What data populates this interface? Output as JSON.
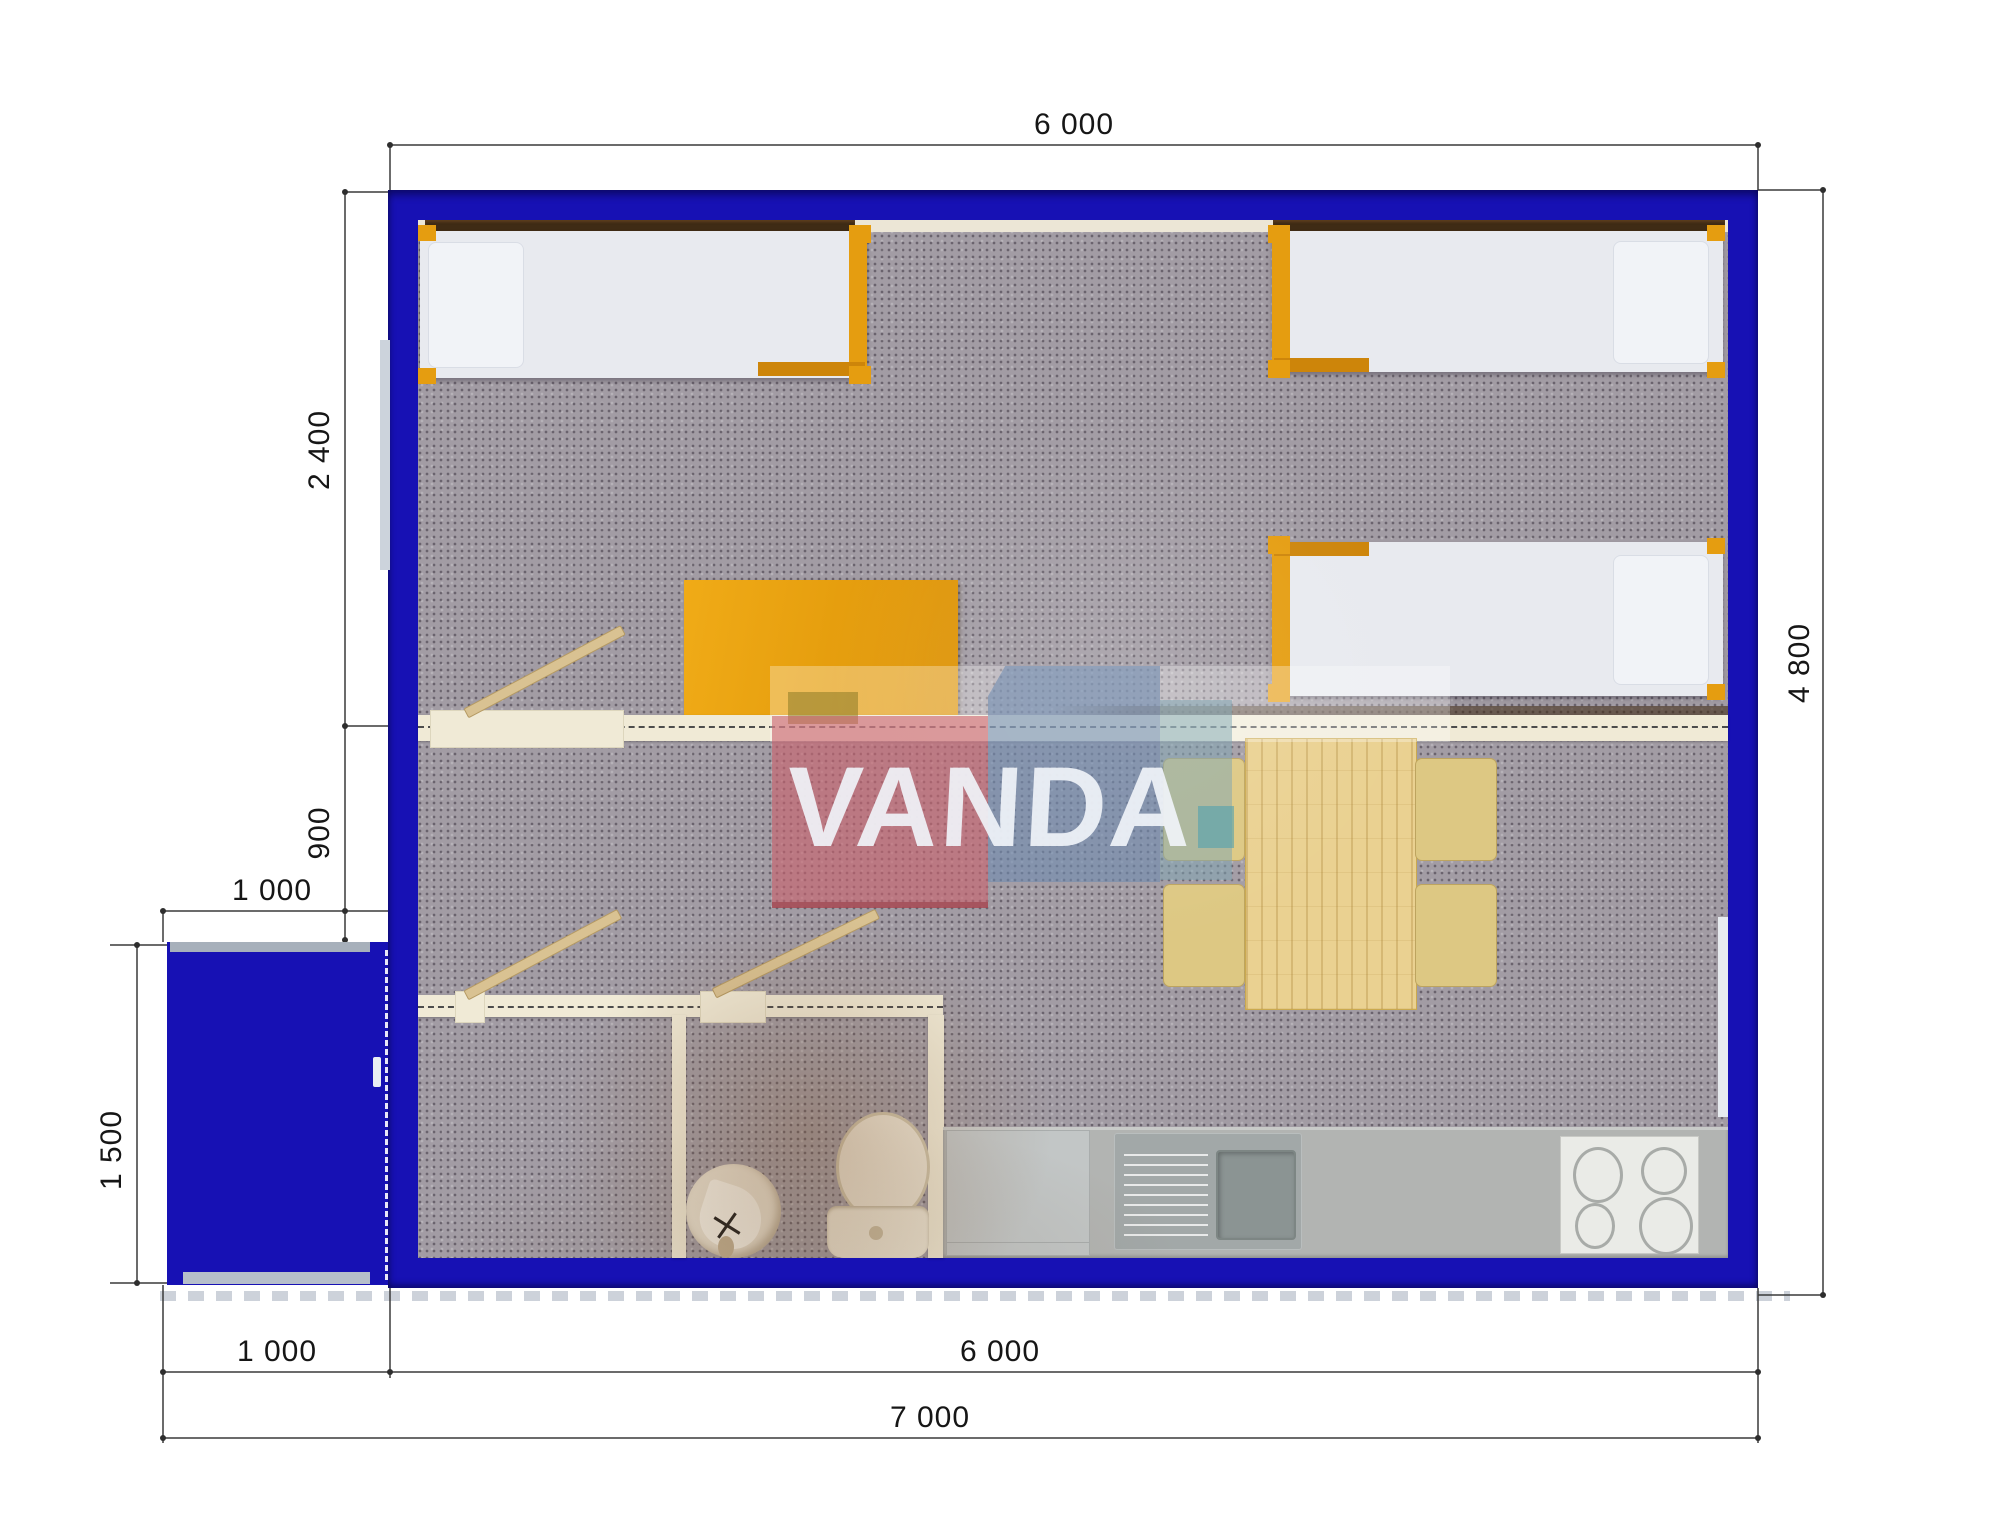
{
  "watermark": {
    "text": "VANDA"
  },
  "dimensions": {
    "top_width": "6 000",
    "room_depth": "2 400",
    "hall_depth": "900",
    "porch_width_top": "1 000",
    "porch_depth": "1 500",
    "bottom_porch_width": "1 000",
    "bottom_main_width": "6 000",
    "bottom_total_width": "7 000",
    "side_height": "4 800"
  },
  "colors": {
    "exterior_wall_blue": "#1711b4",
    "interior_wall_cream": "#f0ead6",
    "furniture_orange": "#e59d10",
    "carpet_gray": "#a29ca4",
    "wood_light": "#ead191",
    "counter_gray": "#b2b4b2",
    "window_dark_brown": "#3f2b15",
    "logo_pink": "#ca626e",
    "logo_blue": "#6c8ab0"
  }
}
